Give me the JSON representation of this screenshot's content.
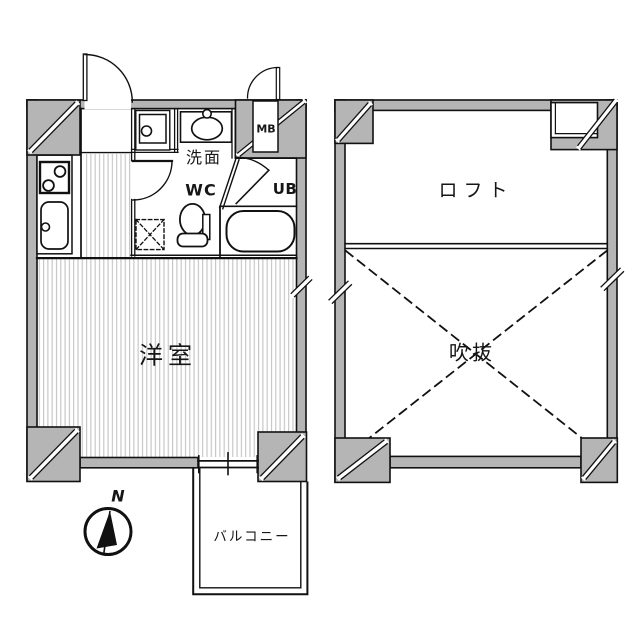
{
  "floorplan": {
    "unit_floor": {
      "room_label": "洋室",
      "washroom_label": "洗面",
      "wc_label": "WC",
      "unit_bath_label": "UB",
      "meter_box_label": "MB",
      "balcony_label": "バルコニー"
    },
    "loft_floor": {
      "loft_label": "ロフト",
      "void_label": "吹抜"
    },
    "compass": {
      "north_label": "N"
    },
    "colors": {
      "wall_fill": "#b5b5b5",
      "line": "#111111",
      "floor_stripe": "#c6c6c6",
      "background": "#ffffff"
    }
  }
}
